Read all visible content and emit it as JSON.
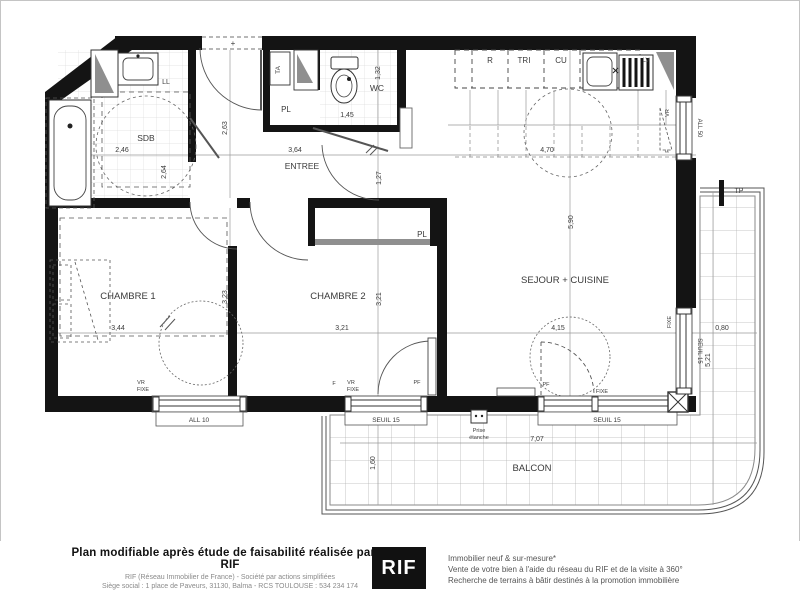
{
  "plan": {
    "rooms": {
      "sdb": "SDB",
      "entree": "ENTREE",
      "wc": "WC",
      "chambre1": "CHAMBRE 1",
      "chambre2": "CHAMBRE 2",
      "sejour": "SEJOUR + CUISINE",
      "balcon": "BALCON",
      "pl": "PL"
    },
    "dims": {
      "d246": "2,46",
      "d264": "2,64",
      "d263": "2,63",
      "d364": "3,64",
      "d132": "1,32",
      "d145": "1,45",
      "d127": "1,27",
      "d470": "4,70",
      "d590": "5,90",
      "d344": "3,44",
      "d321": "3,21",
      "d323": "3,23",
      "d415": "4,15",
      "d080": "0,80",
      "d521": "5,21",
      "d707": "7,07",
      "d160": "1,60"
    },
    "tags": {
      "r": "R",
      "tri": "TRI",
      "cu": "CU",
      "lv": "LV",
      "ll": "LL",
      "ta": "TA",
      "tp": "TP",
      "vr": "VR",
      "f": "F",
      "fixe": "FIXE",
      "pf": "PF",
      "seuil15": "SEUIL 15",
      "all10": "ALL 10",
      "all50": "ALL 50",
      "prise_l1": "Prise",
      "prise_l2": "étanche",
      "plus": "+"
    },
    "colors": {
      "wall": "#141414",
      "grid": "#c9c9c9",
      "gray_fill": "#8f8f8f"
    }
  },
  "footer": {
    "left_title": "Plan modifiable après étude de faisabilité réalisée par le RIF",
    "left_line1": "RIF (Réseau Immobilier de France) - Société par actions simplifiées",
    "left_line2": "Siège social : 1 place de Paveurs, 31130, Balma - RCS TOULOUSE : 534 234 174",
    "logo": "RIF",
    "right_line1": "Immobilier neuf & sur-mesure*",
    "right_line2": "Vente de votre bien à l'aide du réseau du RIF et de la visite à 360°",
    "right_line3": "Recherche de terrains à bâtir destinés à la promotion immobilière"
  }
}
